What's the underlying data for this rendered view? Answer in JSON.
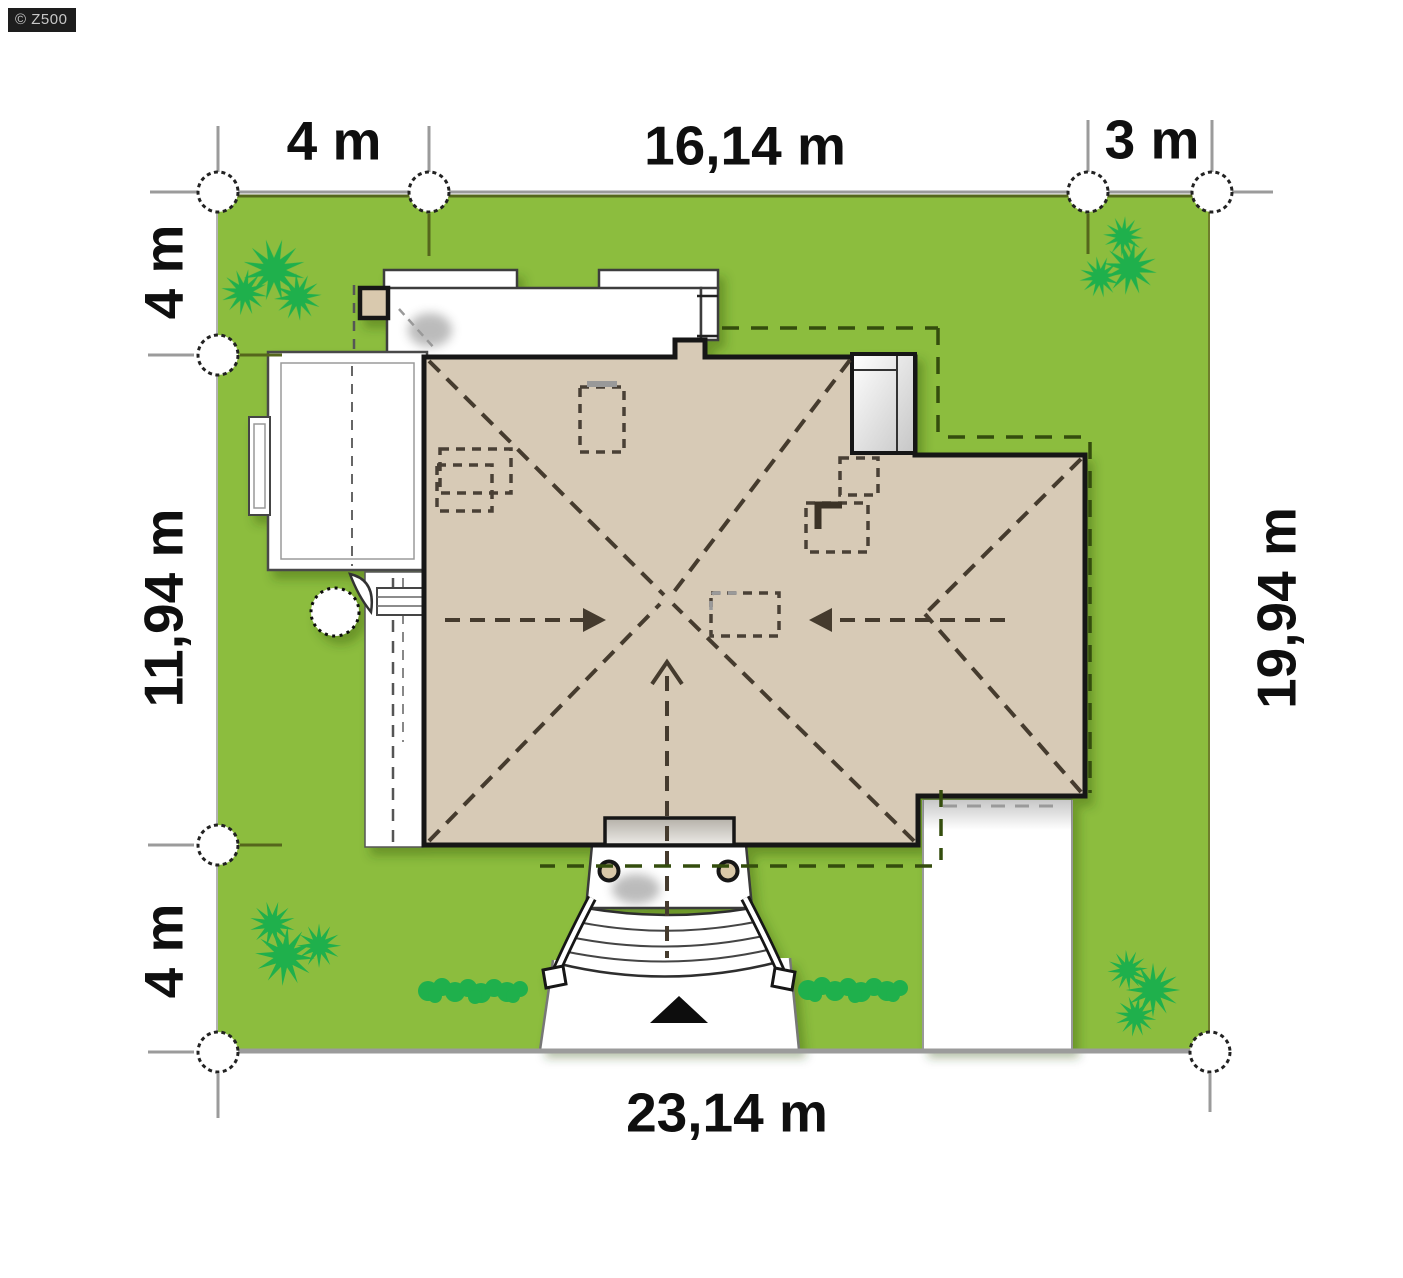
{
  "watermark": {
    "text": "© Z500"
  },
  "plan": {
    "type": "house-site-plan",
    "dimensions": {
      "top": {
        "left": "4 m",
        "middle": "16,14 m",
        "right": "3 m"
      },
      "left": {
        "top": "4 m",
        "middle": "11,94 m",
        "bottom": "4 m"
      },
      "right": {
        "full": "19,94 m"
      },
      "bottom": {
        "full": "23,14 m"
      }
    },
    "colors": {
      "lawn_green": "#8cbd3e",
      "roof_tan": "#d7cab6",
      "vegetation_green": "#1fb04c",
      "outline_black": "#141414",
      "dimension_gray": "#9b9b9b",
      "setback_dash_olive": "#344d0d"
    }
  }
}
